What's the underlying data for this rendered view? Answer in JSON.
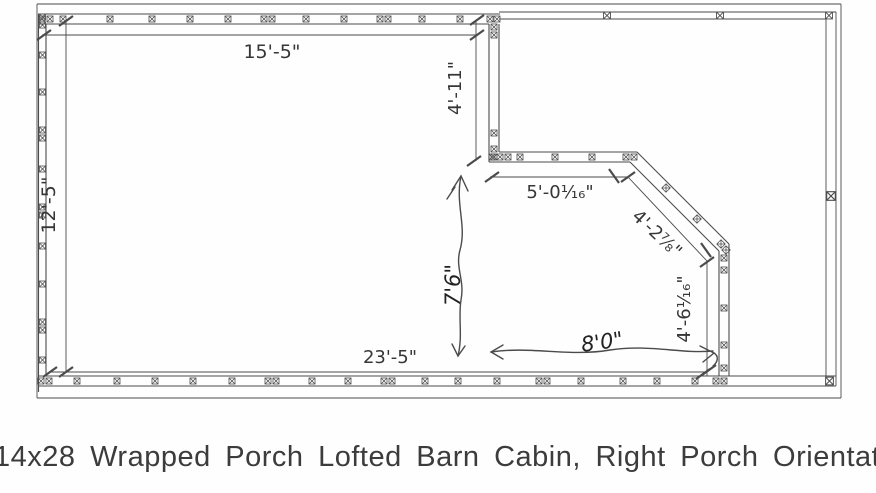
{
  "document": {
    "caption": "14x28 Wrapped Porch Lofted Barn Cabin, Right Porch Orientation"
  },
  "colors": {
    "ink": "#4b4b4b",
    "pencil": "#2e2e2e",
    "text": "#363636"
  },
  "dimensions": {
    "top_width": "15'-5\"",
    "left_height": "12'-5\"",
    "porch_notch_depth": "4'-11\"",
    "notch_width": "5'-0¹⁄₁₆\"",
    "diagonal_wall": "4'-2⁷⁄₈\"",
    "right_wall_segment": "4'-6¹⁄₁₆\"",
    "bottom_width": "23'-5\"",
    "handwritten_height": "7'6\"",
    "handwritten_width": "8'0\""
  }
}
